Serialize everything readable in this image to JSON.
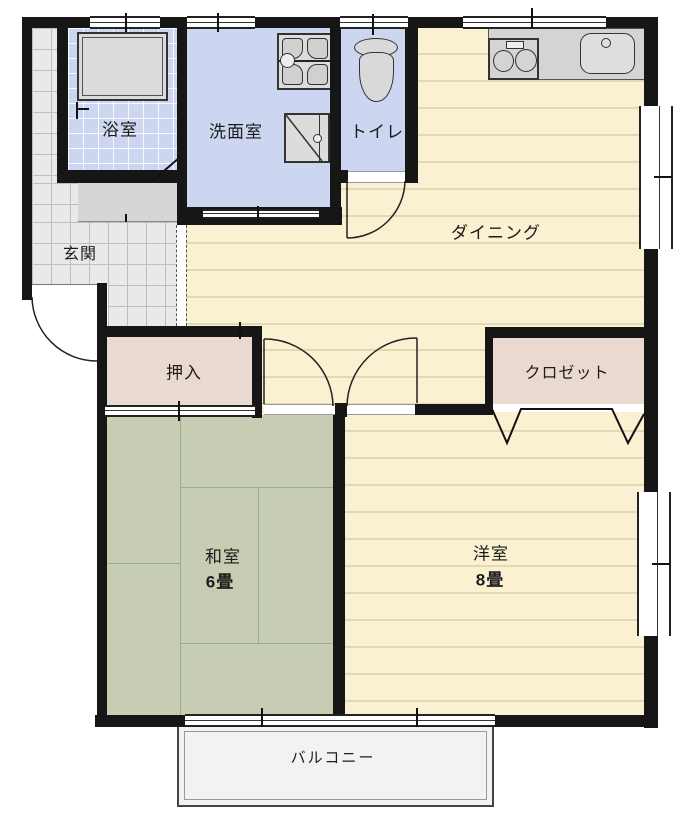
{
  "plan_title": "2DK apartment floor plan",
  "rooms": {
    "bathroom": {
      "label": "浴室"
    },
    "washroom": {
      "label": "洗面室"
    },
    "toilet": {
      "label": "トイレ"
    },
    "dining": {
      "label": "ダイニング"
    },
    "entrance": {
      "label": "玄関"
    },
    "oshiire": {
      "label": "押入"
    },
    "closet": {
      "label": "クロゼット"
    },
    "japanese_room": {
      "label": "和室",
      "size": "6畳"
    },
    "western_room": {
      "label": "洋室",
      "size": "8畳"
    },
    "balcony": {
      "label": "バルコニー"
    }
  },
  "icons": {
    "bathtub": "bathtub-icon",
    "shower_faucet": "shower-faucet-icon",
    "laundry_pan": "laundry-pan-icon",
    "washing_machine": "washing-machine-icon",
    "toilet": "toilet-icon",
    "stove_burners": "stove-burners-icon",
    "kitchen_sink": "kitchen-sink-icon"
  },
  "colors": {
    "wall": "#161616",
    "wood_floor": "#faf0d2",
    "wood_floor_stripe": "#e4d8b2",
    "wet_room_blue": "#ccd6f0",
    "tatami_green": "#c6cdb2",
    "closet_pink": "#ead9d1",
    "entrance_tile": "#e9e9e9",
    "fixture_gray": "#d6d6d6",
    "balcony_gray": "#f2f2f2"
  }
}
